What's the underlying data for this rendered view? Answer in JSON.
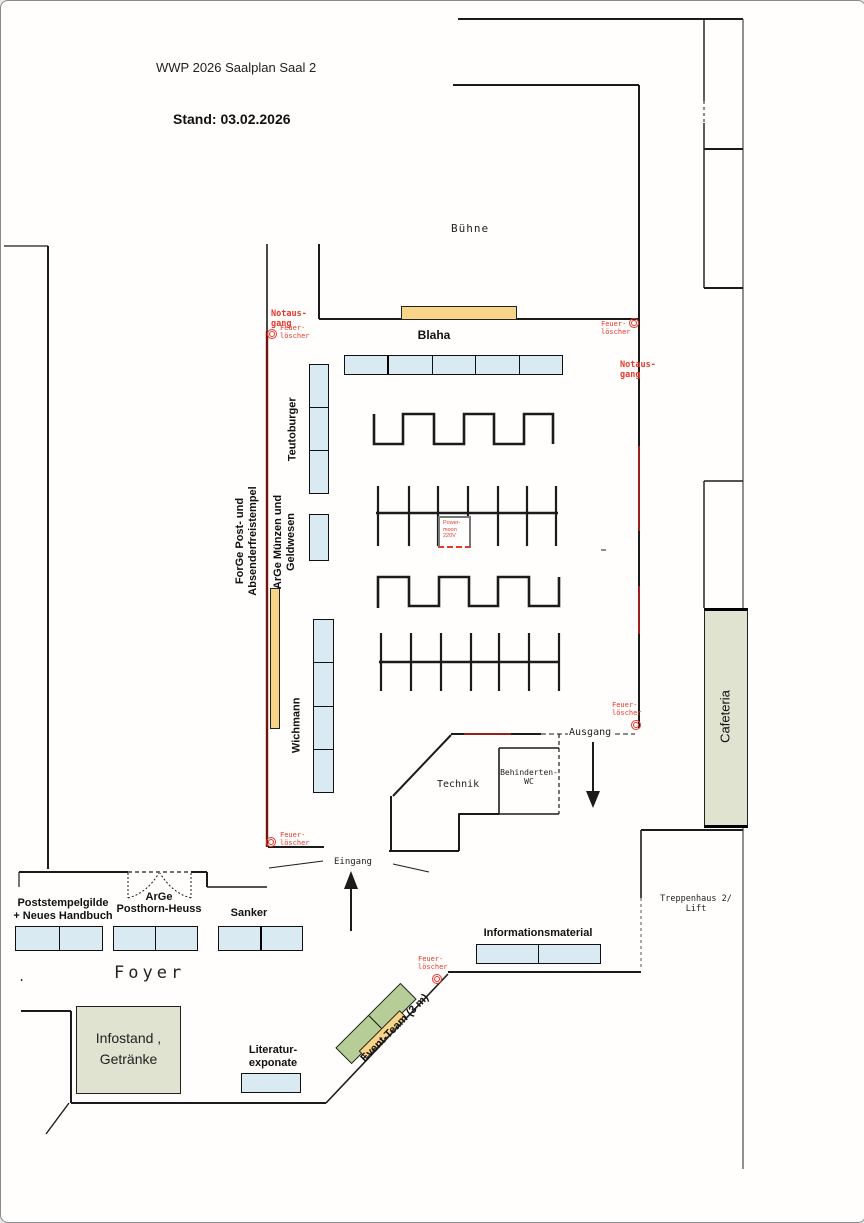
{
  "header": {
    "title": "WWP 2026 Saalplan Saal 2",
    "date_line": "Stand: 03.02.2026"
  },
  "rooms": {
    "stage": "Bühne",
    "technik": "Technik",
    "wc": [
      "Behinderten-",
      "WC"
    ],
    "stairs": [
      "Treppenhaus 2/",
      "Lift"
    ],
    "foyer": "Foyer",
    "foyer_dot": ".",
    "cafeteria": "Cafeteria",
    "exit": "Ausgang",
    "entrance": "Eingang"
  },
  "exhibitors": {
    "blaha": "Blaha",
    "teutoburger": "Teutoburger",
    "wichmann": "Wichmann",
    "forge": [
      "ForGe Post- und",
      "Absenderfreistempel"
    ],
    "arge_muenzen": [
      "ArGe Münzen und",
      "Geldwesen"
    ],
    "poststempelgilde": [
      "Poststempelgilde",
      "+ Neues Handbuch"
    ],
    "arge_posthorn": [
      "ArGe",
      "Posthorn-Heuss"
    ],
    "sanker": "Sanker",
    "informationsmaterial": "Informationsmaterial",
    "literatur": [
      "Literatur-",
      "exponate"
    ],
    "infostand": [
      "Infostand ,",
      "Getränke"
    ],
    "event_team": "Event-Team (3 m)"
  },
  "safety": {
    "emergency_exit": [
      "Notaus-",
      "gang"
    ],
    "extinguisher": [
      "Feuer-",
      "löscher"
    ]
  },
  "power_box": [
    "Power-",
    "moon",
    "220V"
  ],
  "colors": {
    "table_blue": "#daeaf3",
    "stand_orange": "#f8d488",
    "zone_green": "#dfe3cf",
    "team_green": "#b7cd97",
    "alert_red": "#e8372b",
    "wall_maroon": "#701510",
    "wall_red": "#9b1f1a"
  }
}
